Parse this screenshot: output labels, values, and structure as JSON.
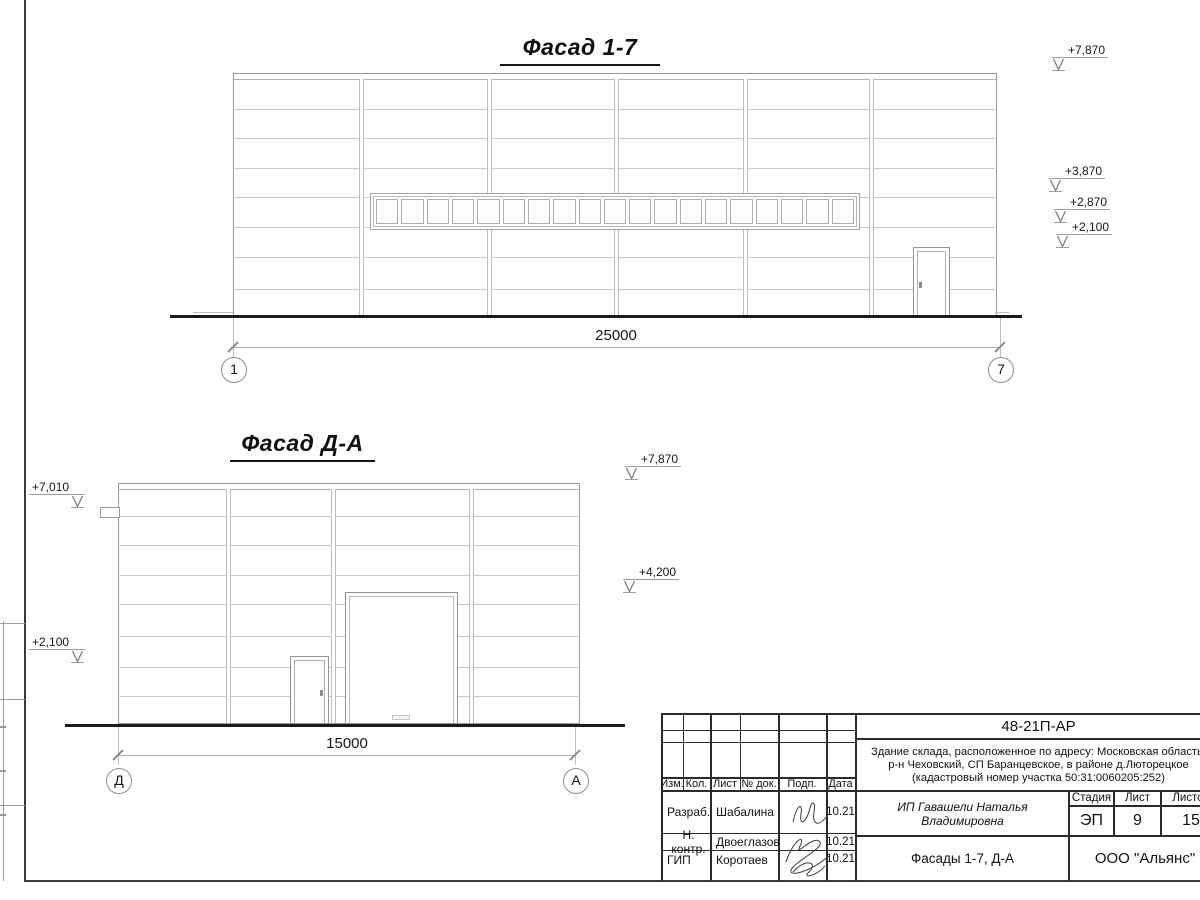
{
  "facade17": {
    "title": "Фасад 1-7",
    "dimension": "25000",
    "axis_left": "1",
    "axis_right": "7",
    "elevations": [
      "+7,870",
      "+3,870",
      "+2,870",
      "+2,100"
    ],
    "window_panes": 19
  },
  "facadeDA": {
    "title": "Фасад Д-А",
    "dimension": "15000",
    "axis_left": "Д",
    "axis_right": "А",
    "elevations_left": [
      "+7,010",
      "+2,100"
    ],
    "elevations_right": [
      "+7,870",
      "+4,200"
    ]
  },
  "stamp": {
    "code": "48-21П-АР",
    "object_description": [
      "Здание склада, расположенное по адресу: Московская область,",
      "р-н Чеховский, СП Баранцевское, в районе д.Люторецкое",
      "(кадастровый номер участка 50:31:0060205:252)"
    ],
    "columns": {
      "izm": "Изм.",
      "kol": "Кол.",
      "list": "Лист",
      "doc": "№ док.",
      "podp": "Подп.",
      "data": "Дата"
    },
    "rows": [
      {
        "role": "Разраб.",
        "name": "Шабалина",
        "date": "10.21"
      },
      {
        "role": "Н. контр.",
        "name": "Двоеглазов",
        "date": "10.21"
      },
      {
        "role": "ГИП",
        "name": "Коротаев",
        "date": "10.21"
      }
    ],
    "customer": "ИП Гавашели Наталья Владимировна",
    "sheet_title": "Фасады 1-7, Д-А",
    "stage_label": "Стадия",
    "sheet_label": "Лист",
    "sheets_label": "Листов",
    "stage": "ЭП",
    "sheet_no": "9",
    "sheets_total": "15",
    "company": "ООО \"Альянс\""
  },
  "colors": {
    "ground_line": "#1b1b1b",
    "wall_line": "#9a9a9a",
    "panel_line": "#c9c9c9",
    "stamp_line": "#2b2b2b"
  }
}
